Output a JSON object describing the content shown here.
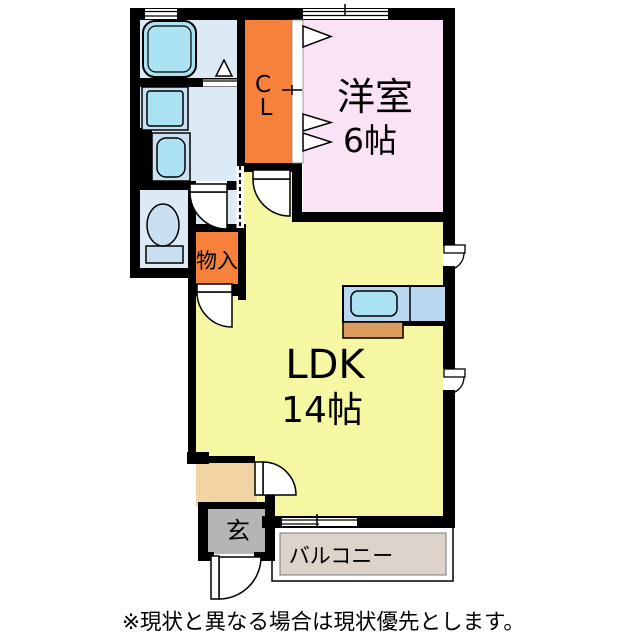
{
  "floorplan": {
    "rooms": {
      "western_room": {
        "name": "洋室",
        "size": "6帖"
      },
      "ldk": {
        "name": "LDK",
        "size": "14帖"
      },
      "closet": {
        "letter_top": "C",
        "letter_bottom": "L"
      },
      "storage": {
        "name": "物入"
      },
      "entrance": {
        "name": "玄"
      },
      "balcony": {
        "name": "バルコニー"
      }
    },
    "note": "※現状と異なる場合は現状優先とします。"
  },
  "colors": {
    "wall": "#000000",
    "western_room": "#FAE3F5",
    "ldk": "#F6F7A3",
    "closet_orange": "#F5813B",
    "wet_area_floor": "#DCEAF6",
    "fixture_panel": "#C9DFF2",
    "fixture_cyan": "#ACE3F2",
    "kitchen_counter": "#B9D7EF",
    "kitchen_base": "#DC9C61",
    "entrance_gray": "#B5B5B7",
    "hall_tan": "#F2D4A2",
    "balcony": "#DCD3CB",
    "door_white": "#FFFFFF"
  }
}
